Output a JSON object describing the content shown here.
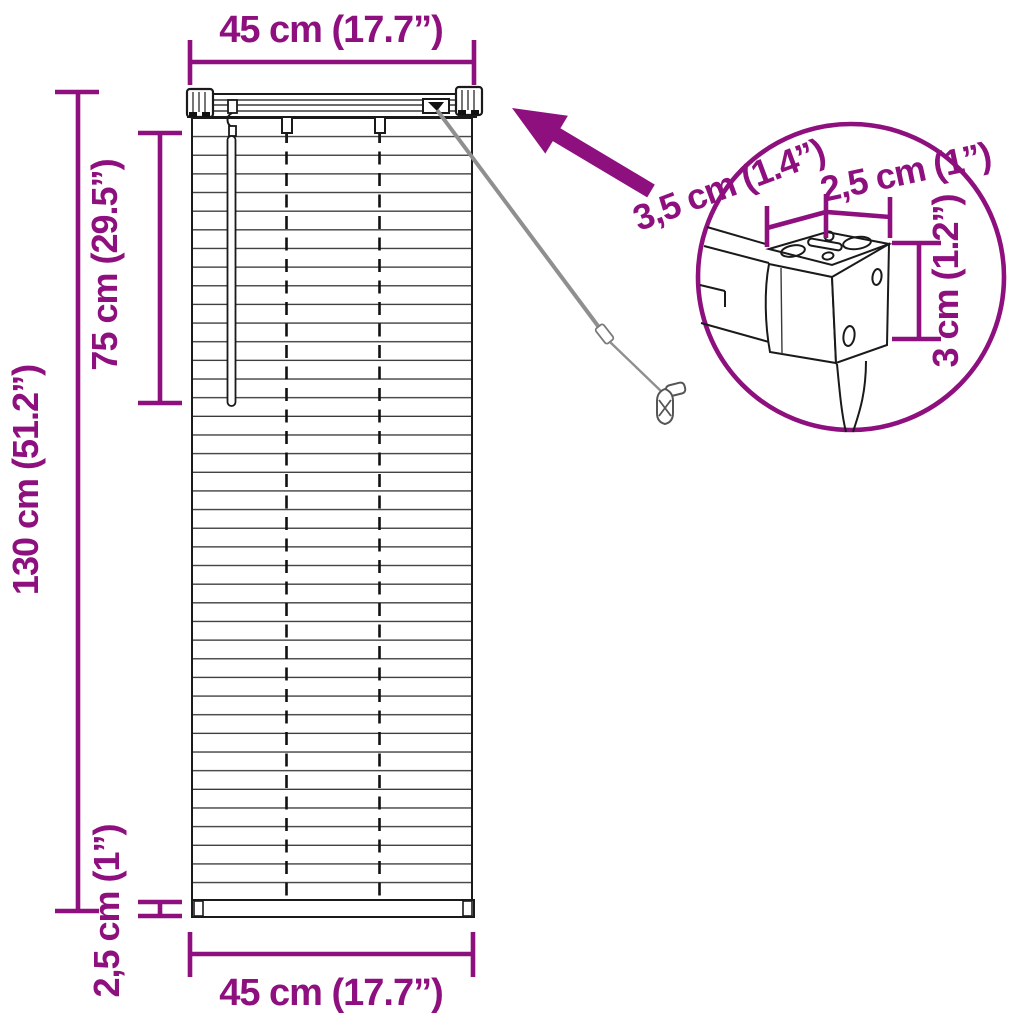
{
  "title": "Venetian blind dimension diagram",
  "colors": {
    "accent": "#8E107E",
    "drawing_line": "#1A1A1A",
    "cord": "#8F8F8F",
    "background": "#FFFFFF"
  },
  "dimensions": {
    "top_width": "45 cm (17.7”)",
    "bottom_width": "45 cm (17.7”)",
    "partial_drop": "75 cm (29.5”)",
    "full_drop": "130 cm (51.2”)",
    "bottom_rail_height": "2,5 cm (1”)",
    "detail": {
      "headrail_depth": "3,5 cm (1.4”)",
      "headrail_width": "2,5 cm (1”)",
      "headrail_height": "3 cm (1.2”)"
    }
  },
  "blind": {
    "slat_count": 42,
    "ladder_string_count": 2,
    "has_tilt_wand": true,
    "has_pull_cord": true
  }
}
